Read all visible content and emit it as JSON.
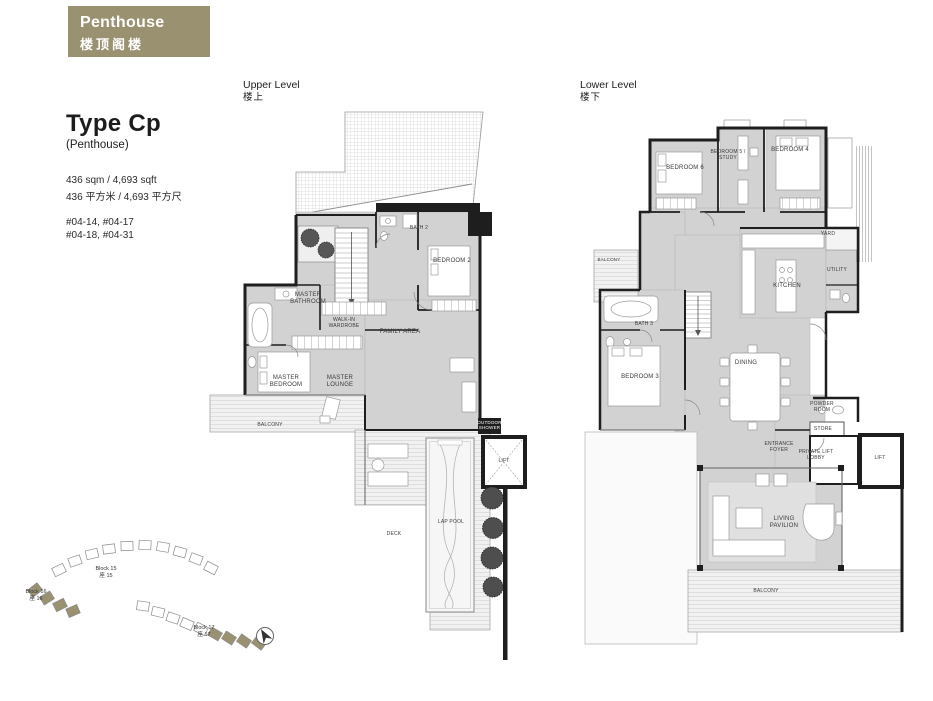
{
  "header": {
    "title": "Penthouse",
    "subtitle": "楼顶阁楼"
  },
  "info": {
    "type_title": "Type Cp",
    "type_subtitle": "(Penthouse)",
    "area_en": "436 sqm / 4,693 sqft",
    "area_zh": "436 平方米 / 4,693 平方尺",
    "units_line1": "#04-14, #04-17",
    "units_line2": "#04-18, #04-31"
  },
  "plans": {
    "upper": {
      "label_en": "Upper Level",
      "label_zh": "楼上",
      "rooms": {
        "master_bedroom": "MASTER BEDROOM",
        "master_lounge": "MASTER LOUNGE",
        "master_bathroom": "MASTER BATHROOM",
        "walk_in_wardrobe": "WALK-IN WARDROBE",
        "bedroom_2": "BEDROOM 2",
        "bath_2": "BATH 2",
        "family_area": "FAMILY AREA",
        "balcony": "BALCONY",
        "deck": "DECK",
        "lap_pool": "LAP POOL",
        "lift": "LIFT",
        "outdoor_shower": "OUTDOOR SHOWER"
      }
    },
    "lower": {
      "label_en": "Lower Level",
      "label_zh": "楼下",
      "rooms": {
        "bedroom_6": "BEDROOM 6",
        "bedroom_5_study": "BEDROOM 5 / STUDY",
        "bedroom_4": "BEDROOM 4",
        "bedroom_3": "BEDROOM 3",
        "bath_3": "BATH 3",
        "kitchen": "KITCHEN",
        "yard": "YARD",
        "utility": "UTILITY",
        "dining": "DINING",
        "powder_room": "POWDER ROOM",
        "store": "STORE",
        "entrance_foyer": "ENTRANCE FOYER",
        "private_lift_lobby": "PRIVATE LIFT LOBBY",
        "lift": "LIFT",
        "living_pavilion": "LIVING PAVILION",
        "balcony": "BALCONY"
      }
    }
  },
  "keyplan": {
    "blocks": [
      {
        "en": "Block 15",
        "zh": "座 15"
      },
      {
        "en": "Block 16",
        "zh": "座 16"
      },
      {
        "en": "Block 17",
        "zh": "座 17"
      }
    ]
  },
  "colors": {
    "badge": "#9a9170",
    "wall": "#1e1e1e",
    "room_fill": "#d2d2d2",
    "highlight_block": "#9a9170"
  }
}
